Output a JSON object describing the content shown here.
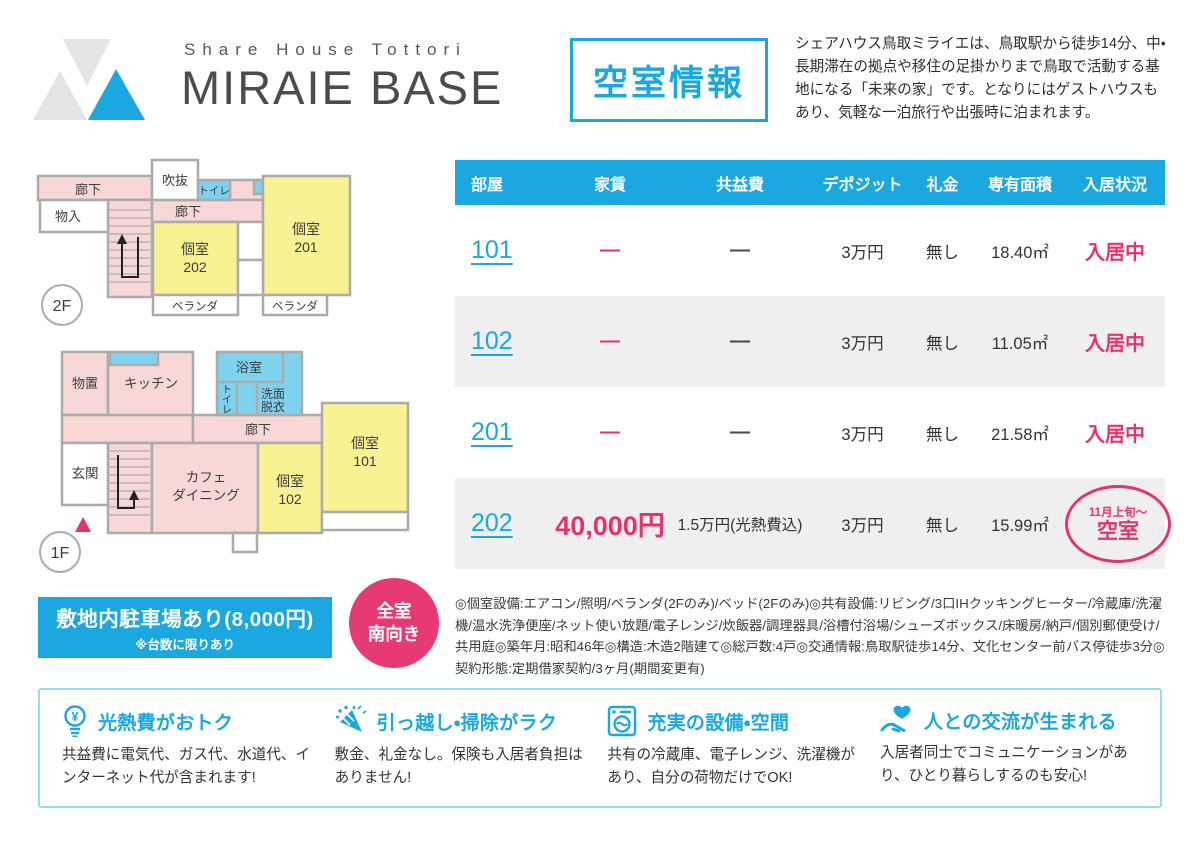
{
  "header": {
    "logo_subtitle": "Share House Tottori",
    "logo_title": "MIRAIE BASE",
    "vacancy_box": "空室情報",
    "description": "シェアハウス鳥取ミライエは、鳥取駅から徒歩14分、中・長期滞在の拠点や移住の足掛かりまで鳥取で活動する基地になる「未来の家」です。となりにはゲストハウスもあり、気軽な一泊旅行や出張時に泊まれます。"
  },
  "floorplans": {
    "floor2": {
      "label": "2F",
      "corridor_top": "廊下",
      "void": "吹抜",
      "toilet": "トイレ",
      "storage": "物入",
      "corridor_mid": "廊下",
      "room202": [
        "個室",
        "202"
      ],
      "room201": [
        "個室",
        "201"
      ],
      "veranda_left": "ベランダ",
      "veranda_right": "ベランダ"
    },
    "floor1": {
      "label": "1F",
      "storage": "物置",
      "kitchen": "キッチン",
      "bath": "浴室",
      "toilet_v": [
        "ト",
        "イ",
        "レ"
      ],
      "washroom": [
        "洗面",
        "脱衣"
      ],
      "corridor": "廊下",
      "entrance": "玄関",
      "cafe": [
        "カフェ",
        "ダイニング"
      ],
      "room102": [
        "個室",
        "102"
      ],
      "room101": [
        "個室",
        "101"
      ]
    }
  },
  "table": {
    "headers": [
      "部屋",
      "家賃",
      "共益費",
      "デポジット",
      "礼金",
      "専有面積",
      "入居状況"
    ],
    "rows": [
      {
        "room": "101",
        "rent": "—",
        "common_fee": "—",
        "deposit": "3万円",
        "key_money": "無し",
        "area": "18.40㎡",
        "status": "入居中"
      },
      {
        "room": "102",
        "rent": "—",
        "common_fee": "—",
        "deposit": "3万円",
        "key_money": "無し",
        "area": "11.05㎡",
        "status": "入居中"
      },
      {
        "room": "201",
        "rent": "—",
        "common_fee": "—",
        "deposit": "3万円",
        "key_money": "無し",
        "area": "21.58㎡",
        "status": "入居中"
      },
      {
        "room": "202",
        "rent": "40,000円",
        "common_fee": "1.5万円(光熱費込)",
        "deposit": "3万円",
        "key_money": "無し",
        "area": "15.99㎡",
        "status_badge": {
          "line1": "11月上旬〜",
          "line2": "空室"
        }
      }
    ],
    "notes": "◎個室設備:エアコン/照明/ベランダ(2Fのみ)/ベッド(2Fのみ)◎共有設備:リビング/3口IHクッキングヒーター/冷蔵庫/洗濯機/温水洗浄便座/ネット使い放題/電子レンジ/炊飯器/調理器具/浴槽付浴場/シューズボックス/床暖房/納戸/個別郵便受け/共用庭◎築年月:昭和46年◎構造:木造2階建て◎総戸数:4戸◎交通情報:鳥取駅徒歩14分、文化センター前バス停徒歩3分◎契約形態:定期借家契約/3ヶ月(期間変更有)"
  },
  "parking": {
    "title": "敷地内駐車場あり(8,000円)",
    "note": "※台数に限りあり"
  },
  "south_badge": {
    "line1": "全室",
    "line2": "南向き"
  },
  "features": [
    {
      "icon": "yen-lightbulb-icon",
      "title": "光熱費がおトク",
      "body": "共益費に電気代、ガス代、水道代、インターネット代が含まれます!"
    },
    {
      "icon": "party-popper-icon",
      "title": "引っ越し・掃除がラク",
      "body": "敷金、礼金なし。保険も入居者負担はありません!"
    },
    {
      "icon": "washing-machine-icon",
      "title": "充実の設備・空間",
      "body": "共有の冷蔵庫、電子レンジ、洗濯機があり、自分の荷物だけでOK!"
    },
    {
      "icon": "hand-heart-icon",
      "title": "人との交流が生まれる",
      "body": "入居者同士でコミュニケーションがあり、ひとり暮らしするのも安心!"
    }
  ],
  "colors": {
    "accent_blue": "#1ba7e0",
    "accent_pink": "#e5336e",
    "plan_pink": "#f8d7d7",
    "plan_yellow": "#f8f293",
    "plan_blue": "#7ed2ee",
    "row_alt_gray": "#f0efef"
  }
}
